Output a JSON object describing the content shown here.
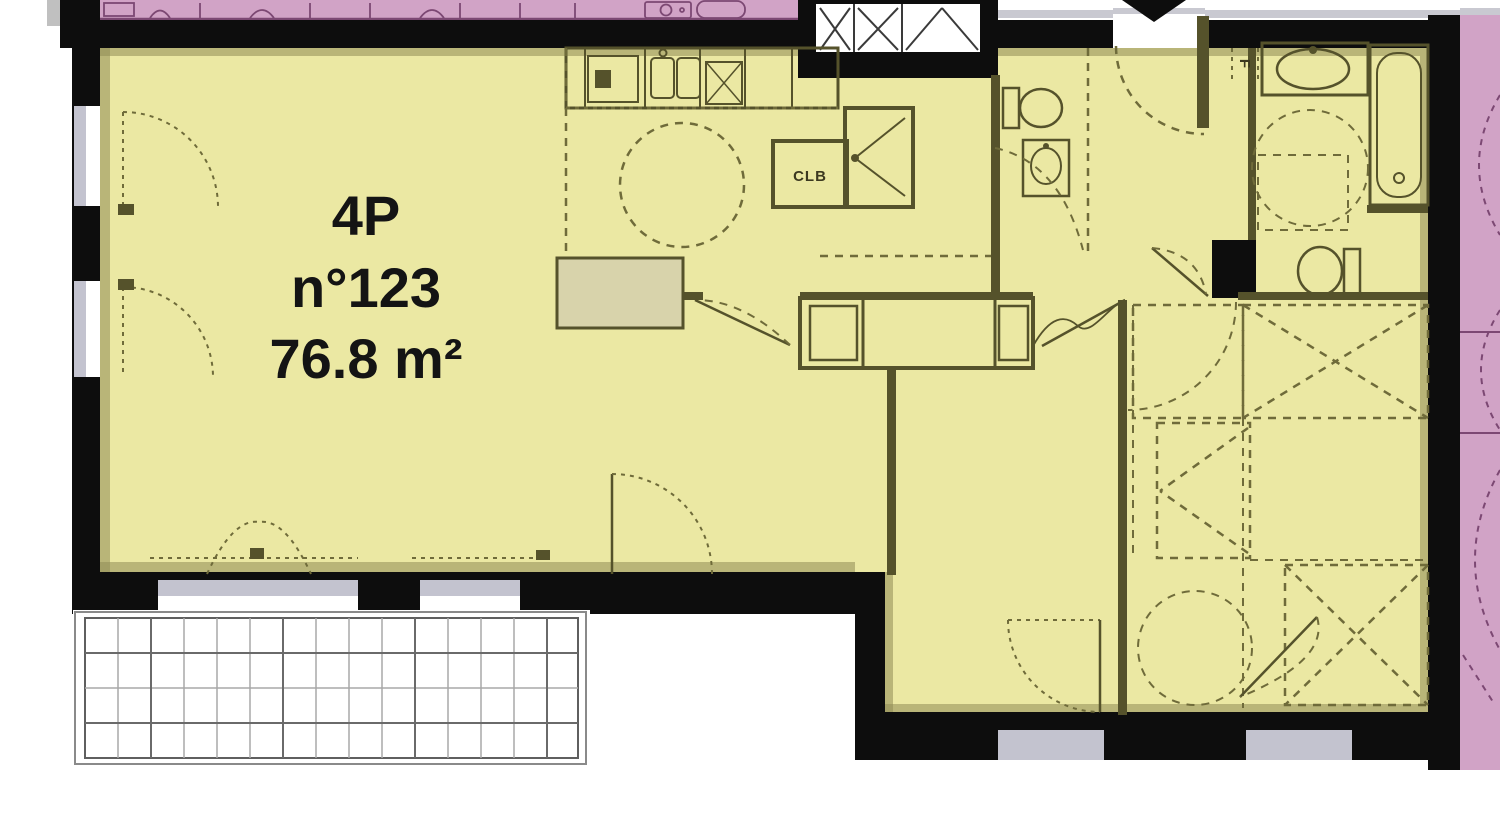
{
  "unit": {
    "type": "4P",
    "number": "n°123",
    "area": "76.8 m²"
  },
  "labels": {
    "closet": "CLB",
    "appliance": "F"
  },
  "colors": {
    "floor": "#ebe8a3",
    "wall": "#0d0d0d",
    "line": "#55522b",
    "dash": "#6f6b3a",
    "pink": "#d1a3c6",
    "pinkLine": "#7c4873",
    "window": "#c3c3cf",
    "sill": "#c9c9d1",
    "counter": "#d8d3ab",
    "lining": "#8f8b55",
    "grid": "#a8a8a8",
    "gridDark": "#6a6a6a",
    "text": "#141414"
  }
}
